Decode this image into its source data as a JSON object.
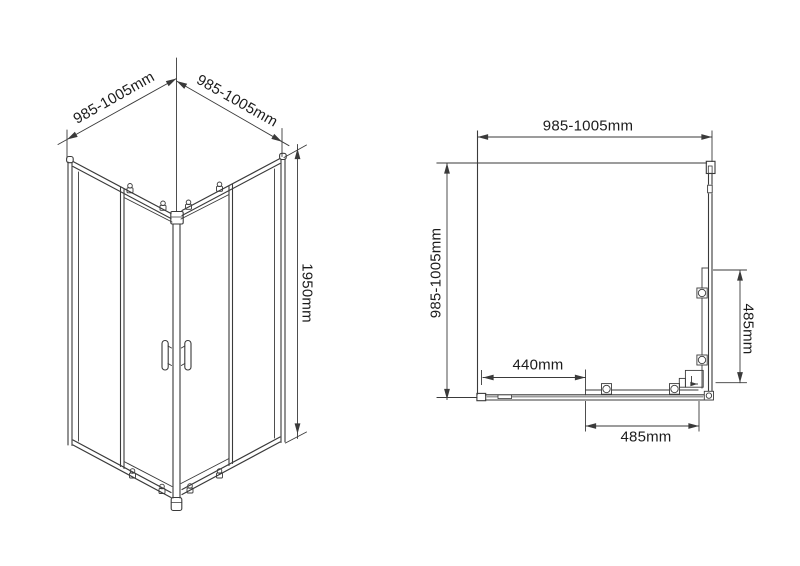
{
  "colors": {
    "line": "#3a3a3a",
    "text": "#1c1c1c",
    "background": "#ffffff"
  },
  "isometric_view": {
    "dim_top_left": "985-1005mm",
    "dim_top_right": "985-1005mm",
    "dim_height": "1950mm"
  },
  "plan_view": {
    "dim_width_top": "985-1005mm",
    "dim_depth_left": "985-1005mm",
    "dim_door_opening": "440mm",
    "dim_bottom_panel": "485mm",
    "dim_side_panel": "485mm"
  }
}
